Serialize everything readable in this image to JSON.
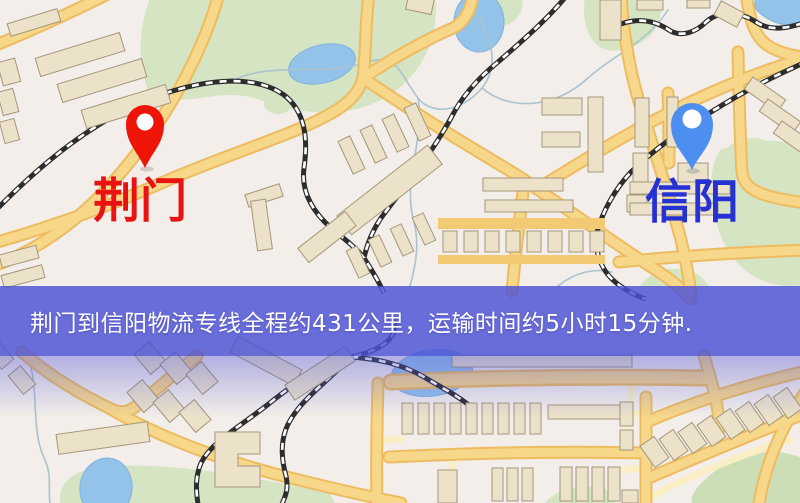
{
  "map": {
    "origin": {
      "name": "荆门",
      "pin_color": "#ee1408",
      "label_color": "#e81212"
    },
    "destination": {
      "name": "信阳",
      "pin_color": "#4d8ff0",
      "label_color": "#2531d3"
    },
    "banner": {
      "text": "荆门到信阳物流专线全程约431公里，运输时间约5小时15分钟.",
      "distance_text": "约431公里",
      "duration_text": "约5小时15分钟",
      "background_color": "#4b50d5",
      "text_color": "#ffffff"
    },
    "palette": {
      "background": "#f3eee9",
      "road": "#f7d78a",
      "road_casing": "#edbc60",
      "minor_road": "#f9eec6",
      "water": "#94c3e9",
      "park": "#d5e4c2",
      "building": "#ece2ca",
      "building_outline": "#a5967a",
      "railway": "#2d2d2d"
    }
  }
}
